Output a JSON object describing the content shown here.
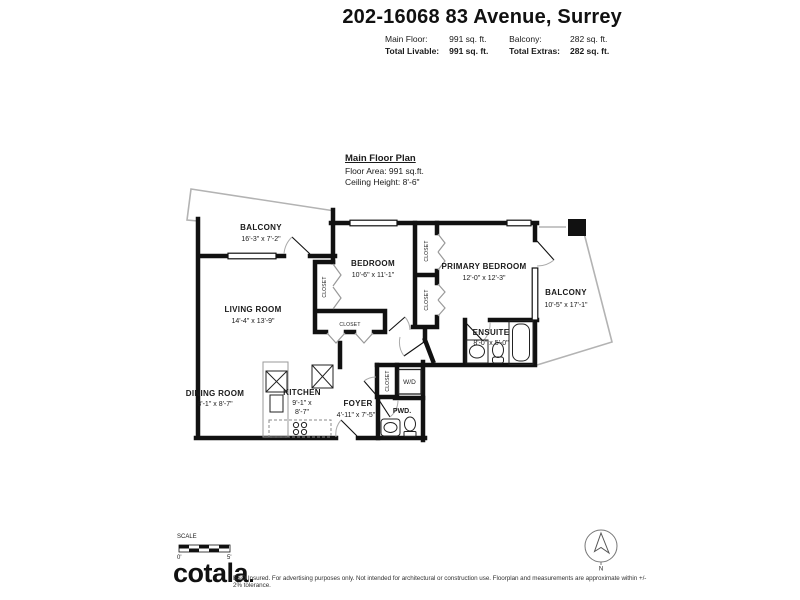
{
  "header": {
    "title": "202-16068 83 Avenue, Surrey",
    "row1": {
      "l1": "Main Floor:",
      "v1": "991 sq. ft.",
      "l2": "Balcony:",
      "v2": "282 sq. ft."
    },
    "row2": {
      "l1": "Total Livable:",
      "v1": "991 sq. ft.",
      "l2": "Total Extras:",
      "v2": "282 sq. ft."
    }
  },
  "plan_info": {
    "title": "Main Floor Plan",
    "floor_area": "Floor Area: 991 sq.ft.",
    "ceiling": "Ceiling Height: 8'-6\""
  },
  "rooms": {
    "balcony_left": {
      "name": "BALCONY",
      "dims": "16'-3\" x 7'-2\""
    },
    "living": {
      "name": "LIVING ROOM",
      "dims": "14'-4\" x 13'-9\""
    },
    "bedroom": {
      "name": "BEDROOM",
      "dims": "10'-6\" x 11'-1\""
    },
    "primary": {
      "name": "PRIMARY BEDROOM",
      "dims": "12'-0\" x 12'-3\""
    },
    "balcony_right": {
      "name": "BALCONY",
      "dims": "10'-5\" x 17'-1\""
    },
    "ensuite": {
      "name": "ENSUITE",
      "dims": "8'-0\" x 5'-0\""
    },
    "dining": {
      "name": "DINING ROOM",
      "dims": "8'-1\" x 8'-7\""
    },
    "kitchen": {
      "name": "KITCHEN",
      "dims_line1": "9'-1\" x",
      "dims_line2": "8'-7\""
    },
    "foyer": {
      "name": "FOYER",
      "dims": "4'-11\" x 7'-5\""
    },
    "pwd": {
      "name": "PWD."
    },
    "wd": {
      "name": "W/D"
    },
    "closet": "CLOSET"
  },
  "footer": {
    "scale_label": "SCALE",
    "scale_start": "0'",
    "scale_end": "5'",
    "logo": "cotala",
    "disclaimer": "E&O Insured. For advertising purposes only. Not intended for architectural or construction use. Floorplan and measurements are approximate within +/- 2% tolerance.",
    "compass_n": "N"
  },
  "colors": {
    "wall": "#111111",
    "railing": "#b3b3b3",
    "text": "#1a1a1a"
  }
}
